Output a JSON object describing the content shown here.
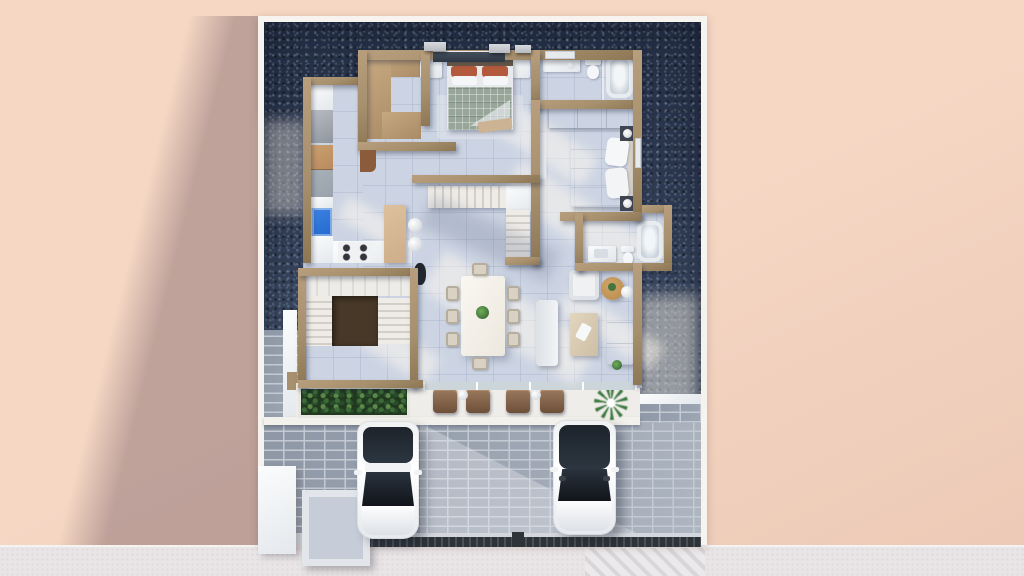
{
  "scene": {
    "kind": "3d-architectural-floor-plan-render",
    "view": "top-down isometric",
    "storey": "ground floor of a house on a gravel lot with front driveway"
  },
  "colors": {
    "bg_peach": "#f5d7c4",
    "bg_peach_dark": "#ecc9b6",
    "street_gray": "#e9e5e6",
    "frame_white": "#f7f4ef",
    "gravel_dark": "#2c3850",
    "gravel_mid": "#41506a",
    "wall_tan": "#a7906e",
    "floor_tile": "#ccd4e3",
    "paver": "#9aa3b0",
    "paver_joint": "#c4cad3",
    "concrete": "#d3d7dd",
    "counter_white": "#eef0f2",
    "cab_tan": "#b98a5e",
    "cab_gray": "#99a1ab",
    "sink_blue": "#2268cf",
    "island_tan": "#cfae8a",
    "stair_void": "#473827",
    "tread_light": "#efece7",
    "tread_dark": "#d2cfc9",
    "bed_blanket": "#98a69a",
    "pillow_rust": "#b25a3b",
    "chair_beige": "#d8d1c4",
    "terrace_white": "#efede9",
    "hedge_dark": "#20391f",
    "hedge_light": "#5d8a4a",
    "wood": "#b8894d",
    "wardrobe_tan": "#b2936f",
    "tub_rim": "#e9ecef",
    "tub_fill": "#c9d2db",
    "car_white": "#f5f6f7",
    "glass_dark": "#232a33",
    "fence_dark": "#2e3338",
    "plant_green": "#3f7a43"
  },
  "rooms": [
    {
      "name": "walk-in-closet",
      "furniture": [
        "c-shaped wardrobe unit"
      ]
    },
    {
      "name": "master-bedroom",
      "furniture": [
        "double bed with plaid blanket",
        "rust pillows",
        "two nightstands",
        "foot bench",
        "rug",
        "window wall"
      ]
    },
    {
      "name": "bathroom-top",
      "furniture": [
        "vanity with sink",
        "toilet",
        "bathtub"
      ]
    },
    {
      "name": "bedroom-2",
      "furniture": [
        "full-width wardrobe",
        "double bed white",
        "two dark nightstands with lamps",
        "mirror"
      ]
    },
    {
      "name": "bathroom-right",
      "furniture": [
        "vanity",
        "toilet",
        "bathtub"
      ]
    },
    {
      "name": "kitchen",
      "furniture": [
        "counter run",
        "fridge",
        "tan cabinets",
        "gray cabinet",
        "blue sink",
        "gas cooktop",
        "island peninsula",
        "two stools",
        "dark plant"
      ]
    },
    {
      "name": "main-staircase",
      "furniture": [
        "upper flight",
        "landing",
        "lower flight"
      ]
    },
    {
      "name": "stair-hall",
      "furniture": [
        "u-shaped stair",
        "dark stairwell void"
      ]
    },
    {
      "name": "dining-area",
      "furniture": [
        "long white table",
        "eight chairs",
        "plant centerpiece",
        "white bench"
      ]
    },
    {
      "name": "living-area",
      "furniture": [
        "armchair",
        "round wood side table",
        "small white table",
        "white sofa",
        "beige coffee table",
        "small plant"
      ]
    }
  ],
  "exterior": {
    "terrace": [
      "hedge planter",
      "four brown lounge chairs",
      "two round side tables",
      "potted palm plant",
      "sliding glass doors"
    ],
    "driveway": [
      "paver bricks",
      "white car left",
      "white car right",
      "dark slatted gate strip",
      "striped crossing corner"
    ],
    "lot": [
      "white border frame",
      "dark blue gravel fill",
      "white side walkway",
      "utility slab",
      "square planter pad",
      "three ac-units on rear ledge"
    ],
    "surroundings": [
      "peach ground plane",
      "diagonal building shadow to the west",
      "light gray street strip at the south"
    ]
  }
}
